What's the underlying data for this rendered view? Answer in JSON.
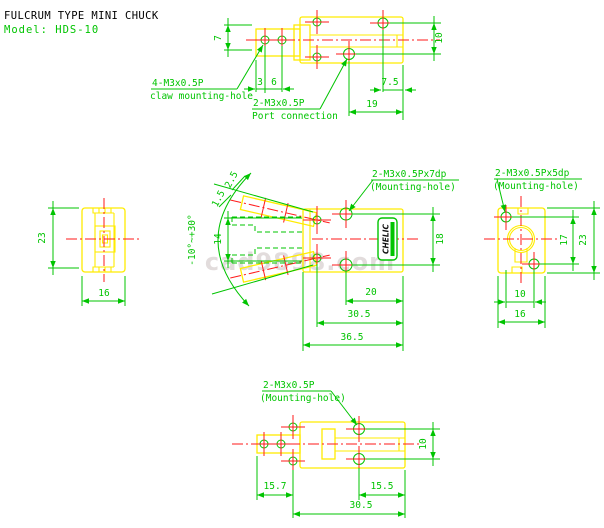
{
  "header": {
    "title": "FULCRUM TYPE MINI CHUCK",
    "model": "Model: HDS-10"
  },
  "watermark": "cad9898.com",
  "logo": {
    "brand": "CHELIC"
  },
  "colors": {
    "outline": "#ffec00",
    "annotation": "#00c400",
    "centerline": "#ff1a1a",
    "title": "#000000",
    "watermark": "#ddd6d6"
  },
  "views": {
    "top": {
      "callout_claw_line1": "4-M3x0.5P",
      "callout_claw_line2": "claw mounting-hole",
      "callout_port_line1": "2-M3x0.5P",
      "callout_port_line2": "Port connection",
      "dim_claw_height": "7",
      "dim_hole_a": "3",
      "dim_hole_b": "6",
      "dim_port_offset_v": "10",
      "dim_edge_offset": "7.5",
      "dim_port_length": "19"
    },
    "front": {
      "callout_line1": "2-M3x0.5Px7dp",
      "callout_line2": "(Mounting-hole)",
      "dim_tip_a": "2.5",
      "dim_tip_b": "1.5",
      "dim_claw_open": "14",
      "dim_swing_angle": "-10°~+30°",
      "dim_hole_span_v": "18",
      "dim_hole_to_end": "20",
      "dim_hole_span_h": "30.5",
      "dim_total_length": "36.5"
    },
    "left": {
      "dim_height": "23",
      "dim_width": "16"
    },
    "right": {
      "callout_line1": "2-M3x0.5Px5dp",
      "callout_line2": "(Mounting-hole)",
      "dim_hole_span_v": "17",
      "dim_height": "23",
      "dim_hole_span_h": "10",
      "dim_width": "16"
    },
    "bottom": {
      "callout_line1": "2-M3x0.5P",
      "callout_line2": "(Mounting-hole)",
      "dim_hole_span_v": "10",
      "dim_left_offset": "15.7",
      "dim_right_offset": "15.5",
      "dim_hole_span_h": "30.5"
    }
  }
}
